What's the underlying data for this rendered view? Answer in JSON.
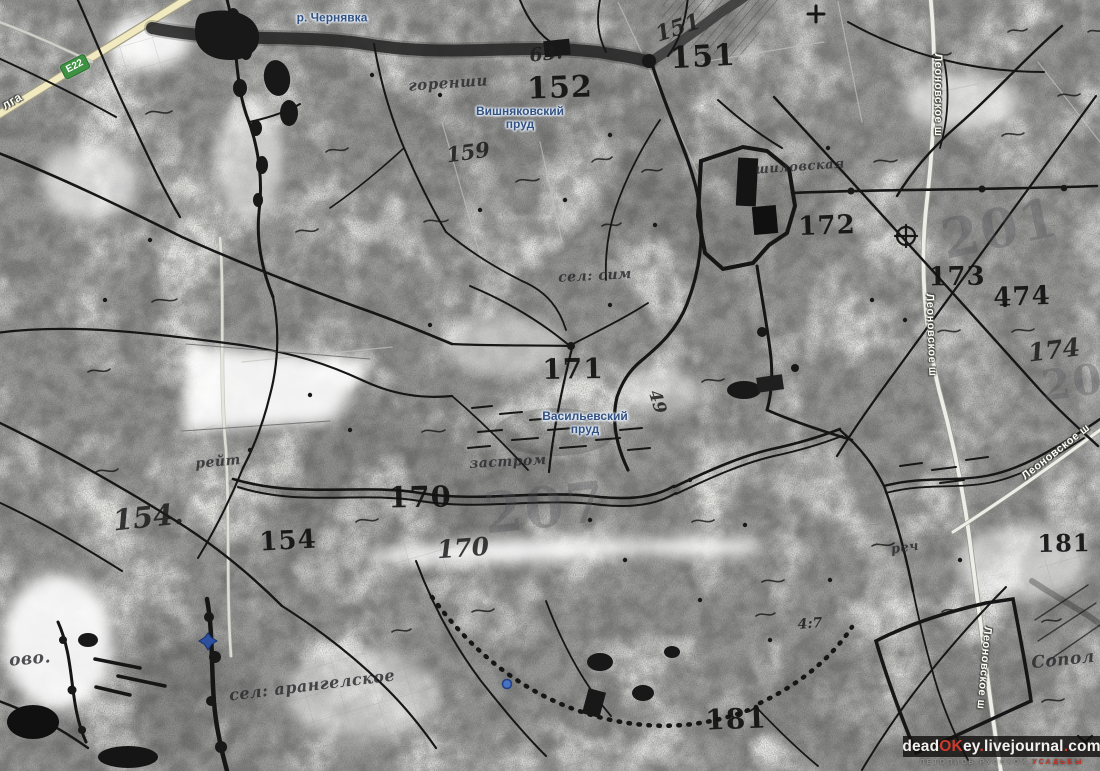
{
  "colors": {
    "paper": "#e9e9e6",
    "ink": "#161616",
    "water_label": "#33517e",
    "water_halo": "#dfe8f4",
    "road_fill": "#f1e9c0",
    "badge_green": "#3f9143",
    "watermark_red": "#cf3a2b",
    "marker_blue": "#3b62b0"
  },
  "route_badge": {
    "label": "E22"
  },
  "road_names": {
    "volga_fragment": "лга",
    "leonovskoe": "Леоновское ш"
  },
  "water_labels": {
    "chernyavka": "р. Чернявка",
    "vishnyakovsky": {
      "line1": "Вишняковский",
      "line2": "пруд"
    },
    "vasilyevsky": {
      "line1": "Васильевский",
      "line2": "пруд"
    }
  },
  "printed_numbers": [
    {
      "text": "151"
    },
    {
      "text": "152"
    },
    {
      "text": "171"
    },
    {
      "text": "172"
    },
    {
      "text": "173"
    },
    {
      "text": "474"
    },
    {
      "text": "170"
    },
    {
      "text": "154"
    },
    {
      "text": "181"
    },
    {
      "text": "181"
    }
  ],
  "handwritten_numbers": [
    {
      "text": "151"
    },
    {
      "text": "159"
    },
    {
      "text": "63."
    },
    {
      "text": "154."
    },
    {
      "text": "170"
    },
    {
      "text": "49"
    },
    {
      "text": "174"
    },
    {
      "text": "4:7"
    }
  ],
  "faded_numbers": [
    {
      "text": "201"
    },
    {
      "text": "205"
    },
    {
      "text": "207"
    }
  ],
  "handwriting_labels": [
    {
      "text": "горенши"
    },
    {
      "text": "сел: сим"
    },
    {
      "text": "шиловская"
    },
    {
      "text": "рейт"
    },
    {
      "text": "застром"
    },
    {
      "text": "реч"
    },
    {
      "text": "сел: арангелское"
    },
    {
      "text": "ово."
    },
    {
      "text": "Сопол"
    }
  ],
  "watermark": {
    "site_segments": [
      {
        "text": "dead"
      },
      {
        "text": "OK"
      },
      {
        "text": "ey"
      },
      {
        "text": "."
      },
      {
        "text": "livejournal"
      },
      {
        "text": "."
      },
      {
        "text": "com"
      }
    ],
    "subtitle_main": "ЛЕТОПИСЬ РУССКОЙ",
    "subtitle_accent": "УСАДЬБЫ"
  }
}
